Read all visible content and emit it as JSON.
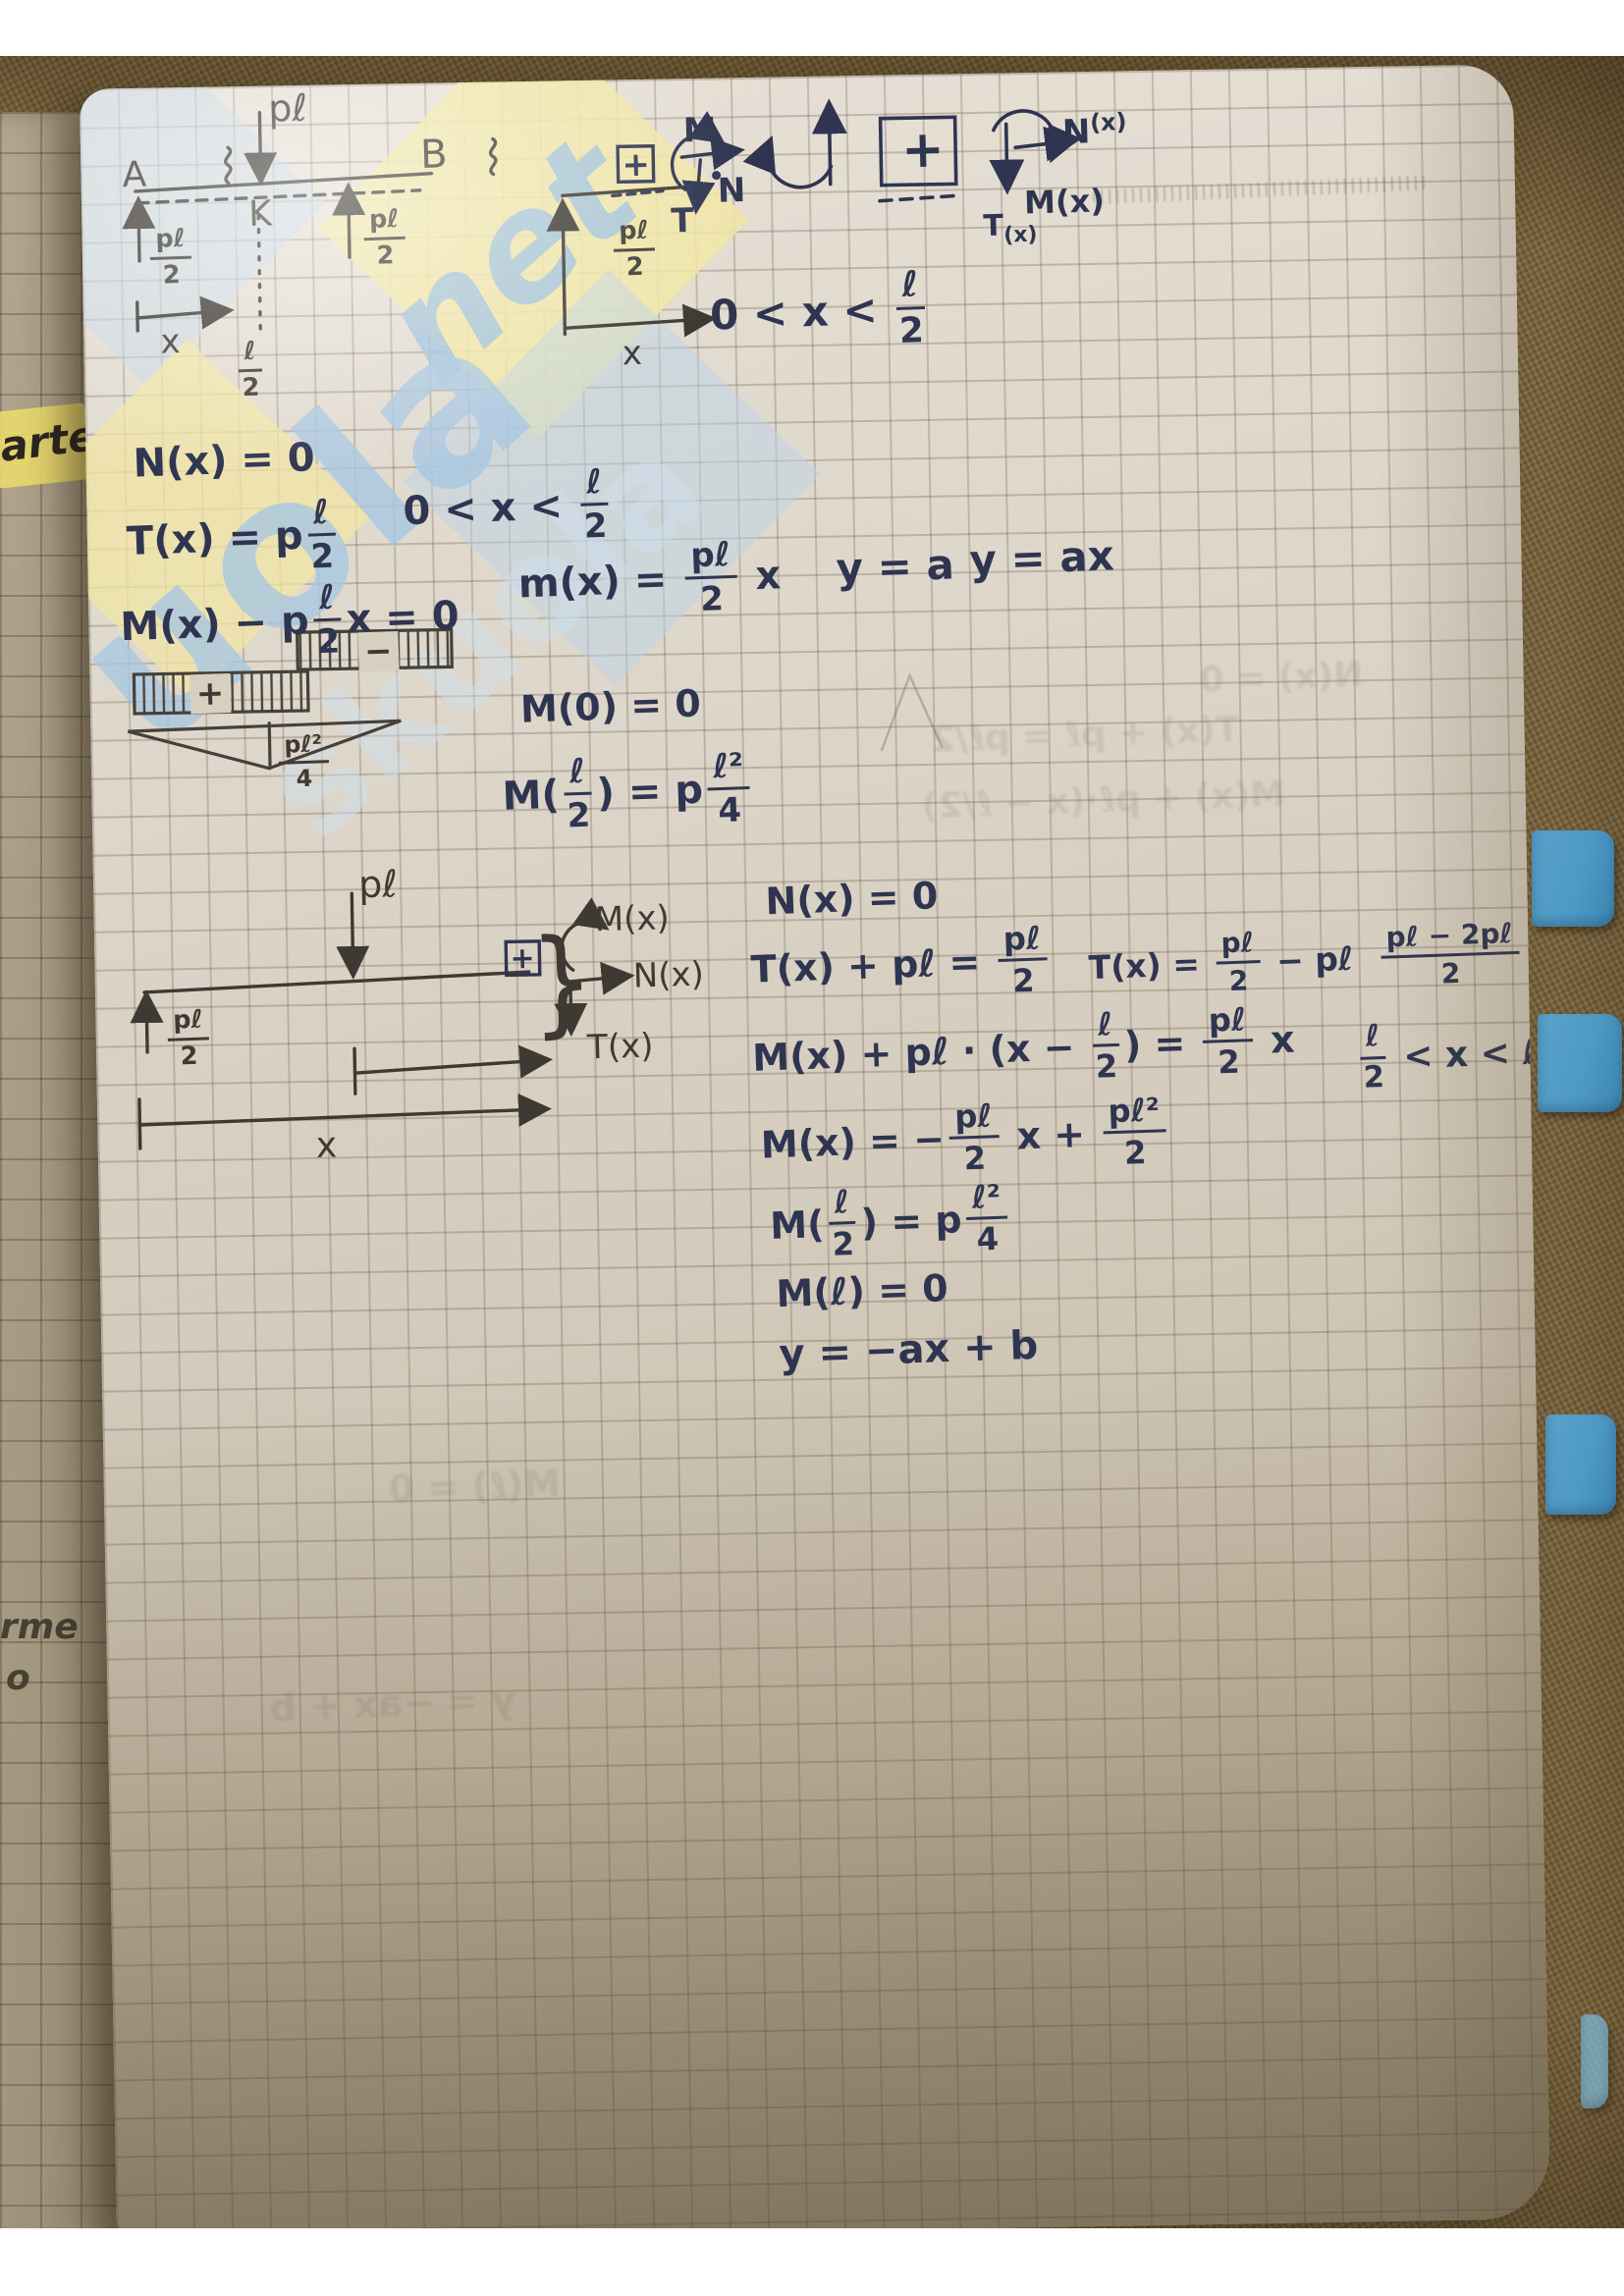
{
  "colors": {
    "ink": "#2f3550",
    "pencil": "#3e3a33",
    "tab_blue": "#4e9ac5",
    "highlight_yellow": "#e9d96b",
    "wm_blue": "#a9c8e2",
    "wm_yellow": "#f1e6a4"
  },
  "watermark": {
    "big": "uola",
    "echo": "skuola",
    "script": "net"
  },
  "margin": {
    "note_top": "arte",
    "note_mid": "rme",
    "note_low": "o"
  },
  "d1": {
    "a": "A",
    "b": "B",
    "k": "K",
    "load": "pℓ",
    "x1": "x",
    "x2": "x",
    "m": "M",
    "n": "N",
    "t": "T",
    "plus": "+",
    "r_left": [
      {
        "t": "f",
        "n": "pℓ",
        "d": "2"
      }
    ],
    "r_right": [
      {
        "t": "f",
        "n": "pℓ",
        "d": "2"
      }
    ],
    "span": [
      {
        "t": "f",
        "n": "ℓ",
        "d": "2"
      }
    ],
    "fbd_r": [
      {
        "t": "f",
        "n": "pℓ",
        "d": "2"
      }
    ]
  },
  "conv": {
    "plus": "+",
    "n_base": "N",
    "n_sup": "(x)",
    "m": "M(x)",
    "t_base": "T",
    "t_sub": "(x)",
    "cond_top": [
      {
        "t": "t",
        "v": "0 < x < "
      },
      {
        "t": "f",
        "n": "ℓ",
        "d": "2"
      }
    ]
  },
  "eqs1": {
    "l1": [
      {
        "t": "t",
        "v": "N(x) = 0"
      }
    ],
    "l2": [
      {
        "t": "t",
        "v": "T(x) = p"
      },
      {
        "t": "f",
        "n": "ℓ",
        "d": "2"
      }
    ],
    "cond_mid": [
      {
        "t": "t",
        "v": "0 < x < "
      },
      {
        "t": "f",
        "n": "ℓ",
        "d": "2"
      }
    ],
    "l3": [
      {
        "t": "t",
        "v": "M(x) − p"
      },
      {
        "t": "f",
        "n": "ℓ",
        "d": "2"
      },
      {
        "t": "t",
        "v": "x = 0"
      }
    ],
    "l4": [
      {
        "t": "t",
        "v": "m(x) = "
      },
      {
        "t": "f",
        "n": "pℓ",
        "d": "2"
      },
      {
        "t": "t",
        "v": " x"
      }
    ],
    "l5": [
      {
        "t": "t",
        "v": "y = a"
      }
    ],
    "l6": [
      {
        "t": "t",
        "v": "y = ax"
      }
    ],
    "l7": [
      {
        "t": "t",
        "v": "M(0) = 0"
      }
    ],
    "l8": [
      {
        "t": "t",
        "v": "M("
      },
      {
        "t": "f",
        "n": "ℓ",
        "d": "2"
      },
      {
        "t": "t",
        "v": ") = p"
      },
      {
        "t": "f",
        "n": "ℓ²",
        "d": "4"
      }
    ],
    "plus": "+",
    "minus": "−",
    "tri_label": [
      {
        "t": "f",
        "n": "pℓ²",
        "d": "4"
      }
    ]
  },
  "d2": {
    "load": "pℓ",
    "plus": "+",
    "brace": "}",
    "m": "M(x)",
    "n": "N(x)",
    "t": "T(x)",
    "x": "x",
    "reaction": [
      {
        "t": "f",
        "n": "pℓ",
        "d": "2"
      }
    ]
  },
  "eqs2": {
    "r1": [
      {
        "t": "t",
        "v": "N(x) = 0"
      }
    ],
    "r2a": [
      {
        "t": "t",
        "v": "T(x) + pℓ = "
      },
      {
        "t": "f",
        "n": "pℓ",
        "d": "2"
      }
    ],
    "r2b": [
      {
        "t": "t",
        "v": "T(x) = "
      },
      {
        "t": "f",
        "n": "pℓ",
        "d": "2"
      },
      {
        "t": "t",
        "v": " − pℓ  "
      },
      {
        "t": "f",
        "n": "pℓ − 2pℓ",
        "d": "2"
      },
      {
        "t": "t",
        "v": " = −"
      },
      {
        "t": "f",
        "n": "pℓ",
        "d": "2"
      }
    ],
    "r3": [
      {
        "t": "t",
        "v": "M(x) + pℓ · (x − "
      },
      {
        "t": "f",
        "n": "ℓ",
        "d": "2"
      },
      {
        "t": "t",
        "v": ") = "
      },
      {
        "t": "f",
        "n": "pℓ",
        "d": "2"
      },
      {
        "t": "t",
        "v": " x"
      }
    ],
    "cond2": [
      {
        "t": "f",
        "n": "ℓ",
        "d": "2"
      },
      {
        "t": "t",
        "v": " < x < ℓ"
      }
    ],
    "r4": [
      {
        "t": "t",
        "v": "M(x) = −"
      },
      {
        "t": "f",
        "n": "pℓ",
        "d": "2"
      },
      {
        "t": "t",
        "v": " x + "
      },
      {
        "t": "f",
        "n": "pℓ²",
        "d": "2"
      }
    ],
    "r5": [
      {
        "t": "t",
        "v": "M("
      },
      {
        "t": "f",
        "n": "ℓ",
        "d": "2"
      },
      {
        "t": "t",
        "v": ") = p"
      },
      {
        "t": "f",
        "n": "ℓ²",
        "d": "4"
      }
    ],
    "r6": [
      {
        "t": "t",
        "v": "M(ℓ) = 0"
      }
    ],
    "r7": [
      {
        "t": "t",
        "v": "y = −ax + b"
      }
    ]
  },
  "bleed": {
    "b1": "N(x) = 0",
    "b2": "T(x) + pℓ = pℓ/2",
    "b3": "M(x) + pℓ·(x − ℓ/2)",
    "b4": "M(ℓ) = 0",
    "b5": "y = −ax + b"
  }
}
